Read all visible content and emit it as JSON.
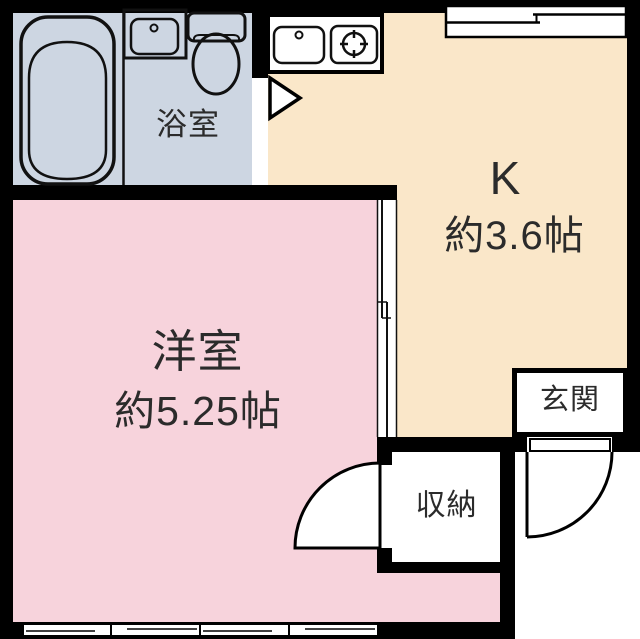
{
  "plan_title": "apartment-floor-plan",
  "rooms": {
    "bathroom": {
      "label": "浴室"
    },
    "kitchen": {
      "label": "K",
      "area": "約3.6帖"
    },
    "western": {
      "label": "洋室",
      "area": "約5.25帖"
    },
    "entrance": {
      "label": "玄関"
    },
    "storage": {
      "label": "収納"
    }
  },
  "colors": {
    "bathroom": "#cdd6e2",
    "kitchen": "#fae7c9",
    "western": "#f7d3dc",
    "wall": "#000000",
    "line": "#111111",
    "text": "#2b2b2b",
    "fixture": "#ffffff"
  },
  "icons": [
    "bathtub-icon",
    "bathroom-sink-icon",
    "toilet-icon",
    "kitchen-sink-icon",
    "stove-burner-icon",
    "bath-door-triangle-icon",
    "sliding-door-icon",
    "entrance-door-swing-icon",
    "closet-door-swing-icon",
    "sliding-window-top-icon",
    "sliding-window-bottom-icon"
  ]
}
